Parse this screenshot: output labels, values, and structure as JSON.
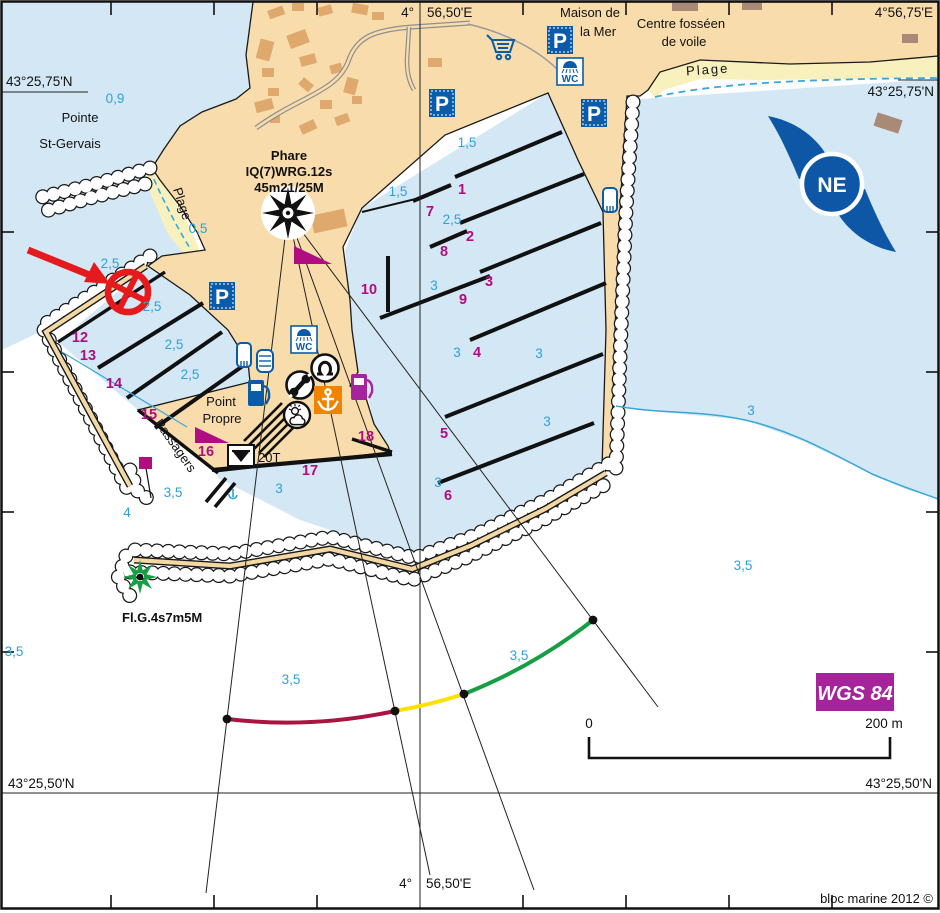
{
  "frame": {
    "lon_main_deg": "4°",
    "lon_main_min": "56,50'E",
    "lon_east": "4°56,75'E",
    "lat_north": "43°25,75'N",
    "lat_south": "43°25,50'N"
  },
  "places": {
    "pointe_line1": "Pointe",
    "pointe_line2": "St-Gervais",
    "plage_cove": "Plage",
    "plage_north": "Plage",
    "maison_line1": "Maison de",
    "maison_line2": "la Mer",
    "centre_line1": "Centre fosséen",
    "centre_line2": "de voile",
    "point_propre_line1": "Point",
    "point_propre_line2": "Propre",
    "passagers": "Passagers"
  },
  "lights": {
    "phare_line1": "Phare",
    "phare_line2": "IQ(7)WRG.12s",
    "phare_line3": "45m21/25M",
    "jetty_light": "Fl.G.4s7m5M"
  },
  "labels": {
    "crane_capacity": "20T",
    "datum": "WGS 84",
    "scale_zero": "0",
    "scale_end": "200 m",
    "credit": "bloc marine 2012 ©",
    "compass": "NE"
  },
  "colors": {
    "water": "#d3e8f4",
    "land": "#f8dcab",
    "beach": "#f8f1bd",
    "building": "#dfa96e",
    "cyan": "#2da2da",
    "magenta": "#b00d81",
    "sign_blue": "#0b5ca8",
    "orange": "#f08300",
    "red": "#e41a1c",
    "green": "#169e44",
    "arc_red": "#a91440",
    "arc_yellow": "#ffe000",
    "arc_green": "#169e44",
    "badge": "#a5239b"
  },
  "map_data": {
    "depths": [
      {
        "v": "0,9",
        "x": 115,
        "y": 103
      },
      {
        "v": "0,5",
        "x": 198,
        "y": 233
      },
      {
        "v": "2,5",
        "x": 110,
        "y": 268
      },
      {
        "v": "2,5",
        "x": 152,
        "y": 311
      },
      {
        "v": "2,5",
        "x": 174,
        "y": 349
      },
      {
        "v": "2,5",
        "x": 190,
        "y": 379
      },
      {
        "v": "1,5",
        "x": 398,
        "y": 196
      },
      {
        "v": "1,5",
        "x": 467,
        "y": 147
      },
      {
        "v": "2,5",
        "x": 452,
        "y": 224
      },
      {
        "v": "3",
        "x": 434,
        "y": 290
      },
      {
        "v": "3",
        "x": 457,
        "y": 357
      },
      {
        "v": "3",
        "x": 539,
        "y": 358
      },
      {
        "v": "3",
        "x": 547,
        "y": 426
      },
      {
        "v": "3",
        "x": 279,
        "y": 493
      },
      {
        "v": "3",
        "x": 438,
        "y": 487
      },
      {
        "v": "3",
        "x": 751,
        "y": 415
      },
      {
        "v": "3,5",
        "x": 173,
        "y": 497
      },
      {
        "v": "4",
        "x": 127,
        "y": 517
      },
      {
        "v": "3,5",
        "x": 14,
        "y": 656
      },
      {
        "v": "3,5",
        "x": 291,
        "y": 684
      },
      {
        "v": "3,5",
        "x": 519,
        "y": 660
      },
      {
        "v": "3,5",
        "x": 743,
        "y": 570
      }
    ],
    "berths": [
      {
        "v": "1",
        "x": 462,
        "y": 194
      },
      {
        "v": "2",
        "x": 470,
        "y": 241
      },
      {
        "v": "3",
        "x": 489,
        "y": 286
      },
      {
        "v": "4",
        "x": 477,
        "y": 357
      },
      {
        "v": "5",
        "x": 444,
        "y": 438
      },
      {
        "v": "6",
        "x": 448,
        "y": 500
      },
      {
        "v": "7",
        "x": 430,
        "y": 216
      },
      {
        "v": "8",
        "x": 444,
        "y": 256
      },
      {
        "v": "9",
        "x": 463,
        "y": 304
      },
      {
        "v": "10",
        "x": 369,
        "y": 294
      },
      {
        "v": "12",
        "x": 80,
        "y": 342
      },
      {
        "v": "13",
        "x": 88,
        "y": 360
      },
      {
        "v": "14",
        "x": 114,
        "y": 388
      },
      {
        "v": "15",
        "x": 149,
        "y": 419
      },
      {
        "v": "16",
        "x": 206,
        "y": 456
      },
      {
        "v": "17",
        "x": 310,
        "y": 475
      },
      {
        "v": "18",
        "x": 366,
        "y": 441
      }
    ]
  }
}
